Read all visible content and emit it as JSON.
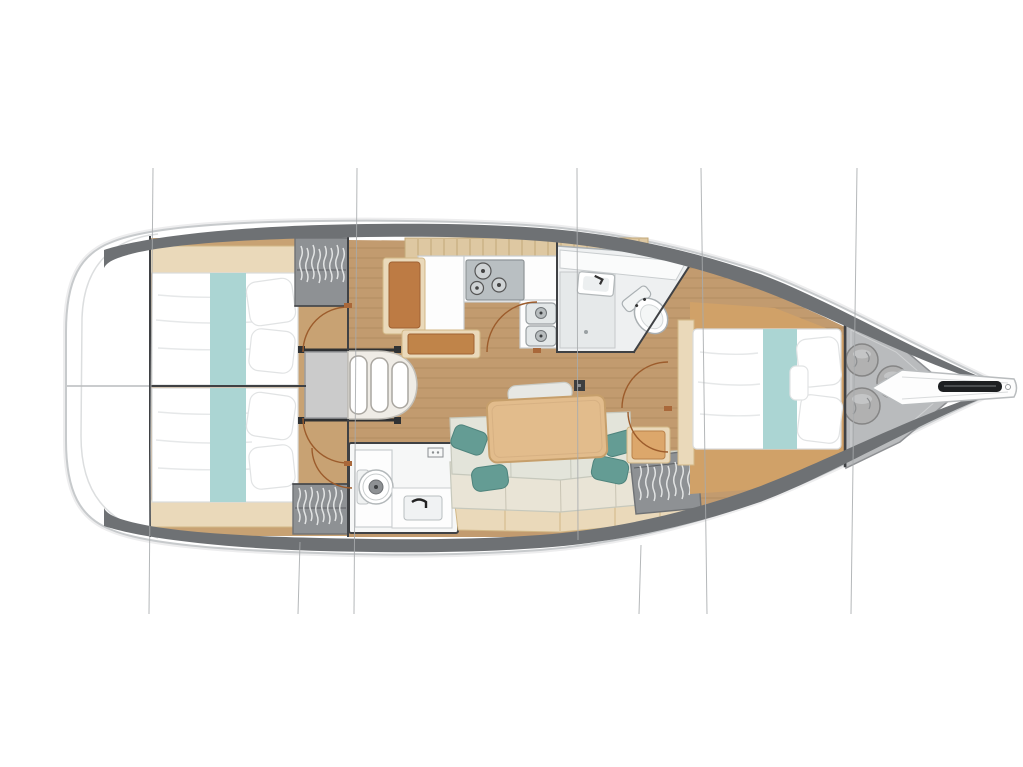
{
  "meta": {
    "title": "Sailboat interior floor plan (top view)"
  },
  "palette": {
    "page_bg": "#ffffff",
    "hull_band": "#6e7174",
    "hull_line": "#c7cacc",
    "wood_floor": "#c29b6f",
    "wood_grain": "#7a5a38",
    "pale_wood": "#ead9ba",
    "pale_wood_line": "#d2b887",
    "tan_surround": "#d0a168",
    "teal_bedding": "#abd5d3",
    "teal_pillow": "#649c94",
    "locker_gray": "#8e9194",
    "locker_line": "#6f7275",
    "fixture_line": "#b3b8ba",
    "dark_wall": "#3f4144",
    "door_arc": "#9c5c2c",
    "settee_seat": "#e3e4da",
    "settee_back": "#e9e4d6",
    "settee_line": "#c6c8bc",
    "table_wood": "#e2bc8c",
    "table_line": "#c69f6b",
    "nav_cushion": "#bd7b44",
    "section_line": "#a8abad",
    "sail_bag": "#b1b1b1",
    "sail_bag_line": "#858585",
    "stove_steel": "#b9bfc2"
  },
  "plan": {
    "type": "yacht-floor-plan",
    "view": "overhead",
    "regions": [
      {
        "name": "stern-transom"
      },
      {
        "name": "aft-cabin-port",
        "features": [
          "double-berth",
          "teal-runner",
          "two-pillows"
        ]
      },
      {
        "name": "aft-cabin-starboard",
        "features": [
          "double-berth",
          "teal-runner",
          "two-pillows"
        ]
      },
      {
        "name": "companionway-steps",
        "steps": 3
      },
      {
        "name": "galley",
        "features": [
          "three-burner-stove",
          "double-sink",
          "counter",
          "overhead-lockers"
        ]
      },
      {
        "name": "nav-station",
        "features": [
          "seat-cushion",
          "chart-table"
        ]
      },
      {
        "name": "forward-head",
        "features": [
          "toilet",
          "sink",
          "shower"
        ]
      },
      {
        "name": "aft-head",
        "features": [
          "toilet",
          "sink",
          "counter"
        ]
      },
      {
        "name": "salon",
        "features": [
          "l-settee",
          "dining-table",
          "mast-post",
          "teal-cushions"
        ]
      },
      {
        "name": "forward-cabin",
        "features": [
          "double-berth",
          "teal-runner",
          "pillows",
          "seat"
        ]
      },
      {
        "name": "sail-locker",
        "sail_bags": 3
      },
      {
        "name": "bow-anchor-roller"
      }
    ],
    "hanging_lockers": 3,
    "section_lines": 7,
    "door_swings": 6
  }
}
